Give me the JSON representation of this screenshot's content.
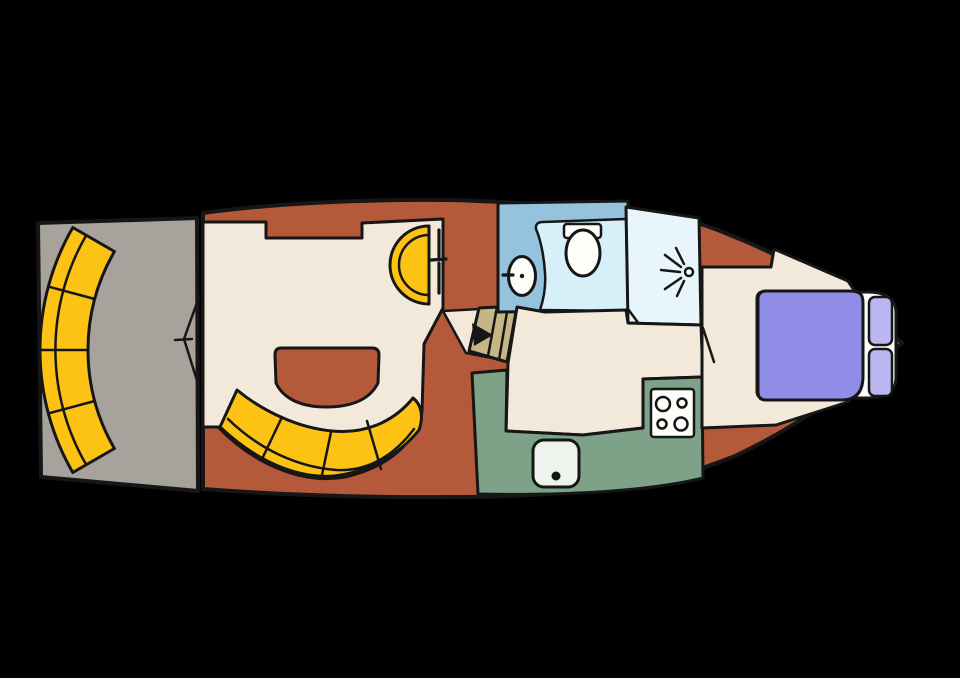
{
  "canvas": {
    "width": 960,
    "height": 678,
    "background": "#000000"
  },
  "diagram_type": "boat-floorplan",
  "palette": {
    "outline": "#161616",
    "hull_walkway": "#b4593a",
    "aft_deck_gray": "#a7a29b",
    "seating_yellow": "#fcc315",
    "floor_cream": "#f2e9da",
    "galley_green": "#7da287",
    "head_blue": "#95c2dd",
    "toilet_floor_blue": "#d7eff8",
    "shower_floor_blue": "#e8f6fb",
    "stairs_tan": "#c7b685",
    "bed_purple": "#8f8de6",
    "pillow_purple": "#bab6ef",
    "fixture_white": "#fdfdfa",
    "galley_sink_white": "#eef3ee"
  },
  "icons": {
    "shower_spray": "radiating-lines-with-dot",
    "stair_direction": "black-triangle-pointing-right",
    "door_swing": "thin-diagonal-line",
    "stern_door": "chevron-lines",
    "tap": "short-stub-line",
    "stove_burners": "four-circles",
    "drain": "black-dot"
  }
}
